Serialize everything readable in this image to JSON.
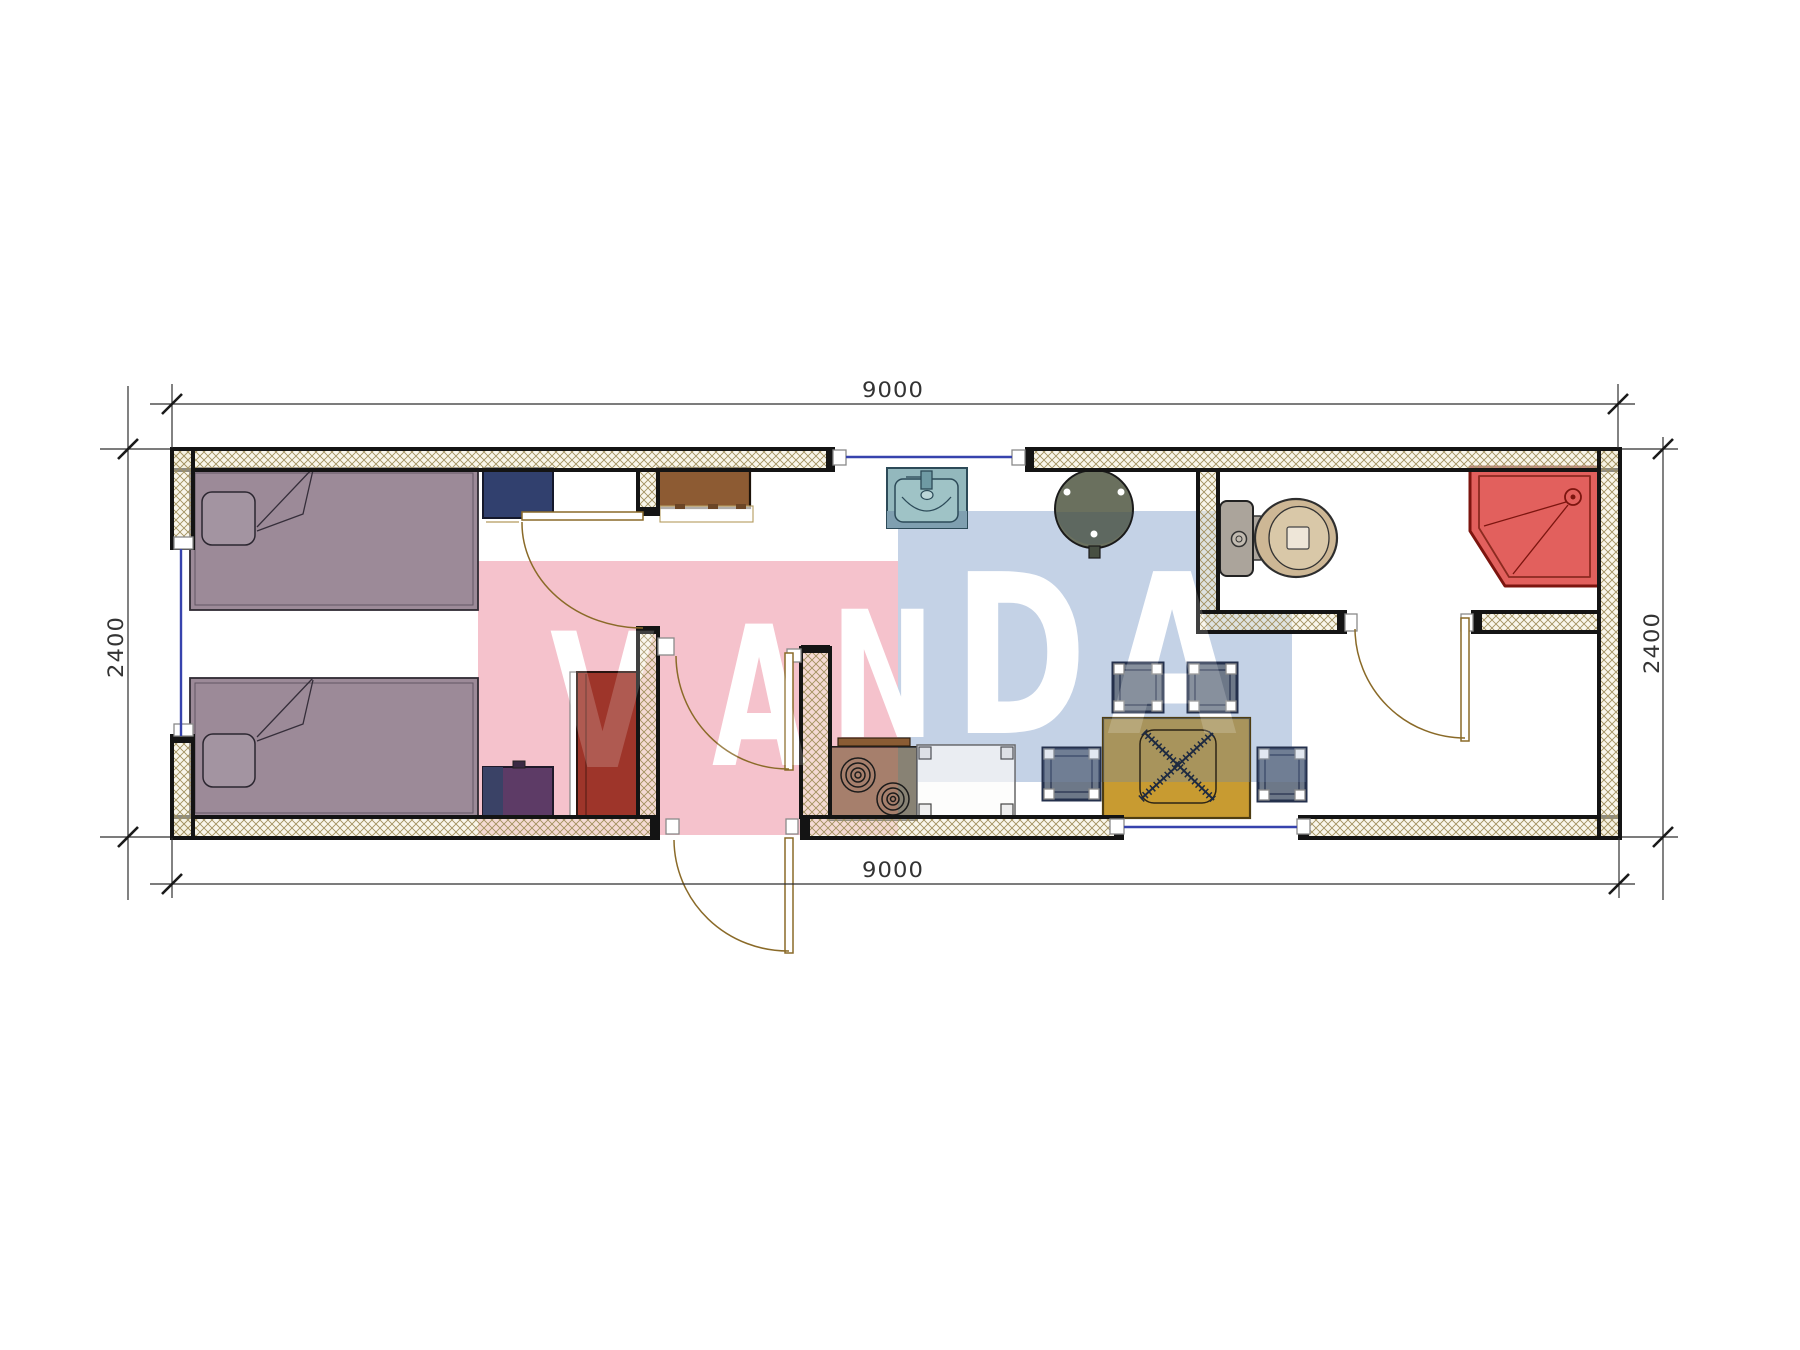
{
  "watermark": {
    "text": "VANDA",
    "letters": [
      {
        "ch": "V"
      },
      {
        "ch": "A"
      },
      {
        "ch": "N"
      },
      {
        "ch": "D"
      },
      {
        "ch": "A"
      }
    ],
    "pink": "#f5c2cc",
    "blue": "#c4d2e6",
    "letter_color": "#ffffff"
  },
  "dimensions": {
    "top": "9000",
    "bottom": "9000",
    "left": "2400",
    "right": "2400"
  },
  "colors": {
    "wall_hatch_line": "#a1905e",
    "wall_edge": "#141414",
    "window_blue": "#3743ad",
    "door_arc": "#8a6a28",
    "bed": "#9c8a98",
    "pillow": "#a394a1",
    "nightstand_navy": "#31406e",
    "cabinet_brown": "#8d5b33",
    "wardrobe_red": "#9e352a",
    "accent_purple": "#5d3b66",
    "accent_navy": "#3a4266",
    "sink_teal": "#93b8bd",
    "sink_strip": "#7f9fb0",
    "table_round": "#6a705e",
    "stool_slate": "#6d7888",
    "stool_outline": "#24304c",
    "table_yellow": "#c89b31",
    "stove_khaki": "#8d7a58",
    "counter_white": "#fdfdfc",
    "toilet_tank": "#aba49b",
    "toilet_bowl": "#cdb795",
    "toilet_seat": "#d9c8a8",
    "shower_red": "#e2605d",
    "shower_outline": "#7c150f",
    "dim_text": "#333333"
  },
  "plan": {
    "furniture": [
      "single-bed",
      "single-bed",
      "pillow",
      "nightstand",
      "closet-cabinet",
      "wardrobe",
      "purple-cabinet",
      "kitchen-sink",
      "round-pedestal-table",
      "cooktop-stove",
      "counter-table",
      "stool",
      "folding-dining-table",
      "toilet",
      "corner-shower-tray"
    ],
    "window_count": 3,
    "door_count": 4
  }
}
